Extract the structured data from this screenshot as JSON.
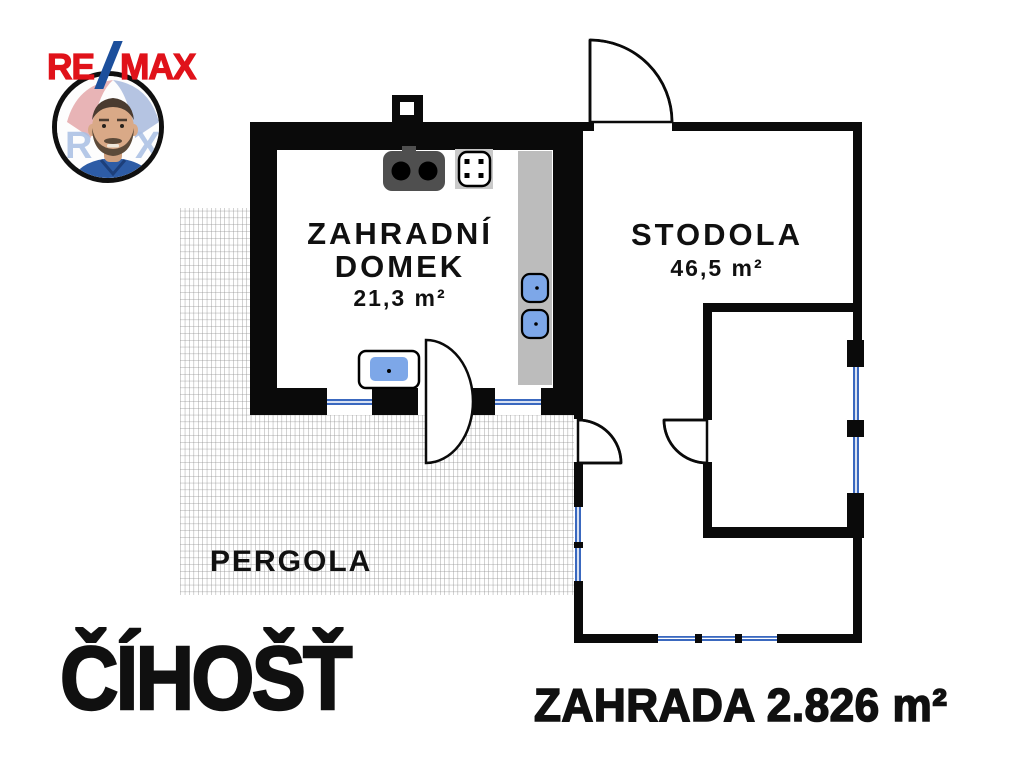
{
  "branding": {
    "wordmark": {
      "re": "RE",
      "slash": "/",
      "max": "MAX"
    },
    "avatar_balloon": {
      "left_letter": "R",
      "right_letter": "X"
    }
  },
  "plan": {
    "garden_house": {
      "name_line1": "ZAHRADNÍ",
      "name_line2": "DOMEK",
      "area": "21,3 m²"
    },
    "barn": {
      "name": "STODOLA",
      "area": "46,5 m²"
    },
    "pergola": {
      "name": "PERGOLA"
    }
  },
  "footer": {
    "location": "ČÍHOŠŤ",
    "garden_label": "ZAHRADA 2.826 m²"
  },
  "colors": {
    "wall_black": "#0a0a0a",
    "window_blue": "#3a68bf",
    "furniture_blue": "#7da7e8",
    "counter_gray": "#bcbcbc",
    "stove_gray": "#4f4f4f",
    "remax_red": "#e0121a",
    "remax_blue": "#1c4f9c",
    "text_black": "#101010"
  }
}
